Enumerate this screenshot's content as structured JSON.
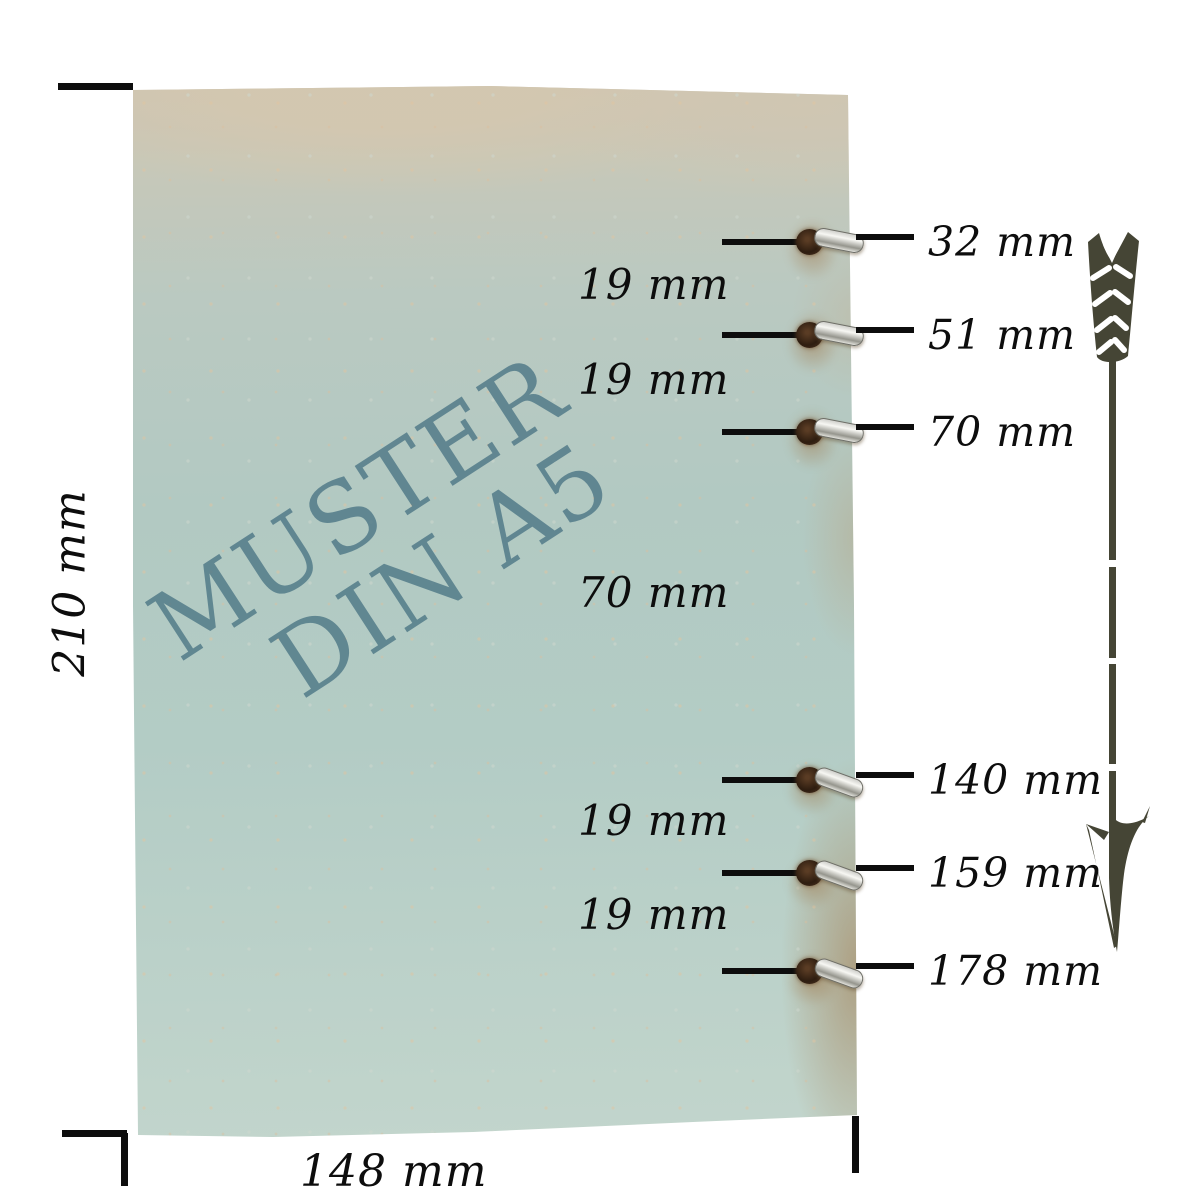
{
  "paper": {
    "watermark": {
      "line1": "MUSTER",
      "line2": "DIN A5"
    }
  },
  "dimensions": {
    "height_label": "210 mm",
    "width_label": "148 mm"
  },
  "hole_measurements": [
    {
      "label": "32 mm"
    },
    {
      "label": "51 mm"
    },
    {
      "label": "70 mm"
    },
    {
      "label": "140 mm"
    },
    {
      "label": "159 mm"
    },
    {
      "label": "178 mm"
    }
  ],
  "gap_measurements": [
    {
      "label": "19 mm"
    },
    {
      "label": "19 mm"
    },
    {
      "label": "70 mm"
    },
    {
      "label": "19 mm"
    },
    {
      "label": "19 mm"
    }
  ],
  "icons": {
    "arrow": "down-arrow-icon"
  },
  "colors": {
    "watermark_teal": "#4e7886",
    "paper_blue": "#b3ccc5",
    "paper_tan": "#cdc5b2",
    "stain_brown": "#9e7546",
    "ring_silver": "#d6d6d2",
    "hole_brown": "#2e1d10",
    "arrow_olive": "#454535",
    "line_black": "#0d0d0d",
    "background": "#ffffff"
  }
}
